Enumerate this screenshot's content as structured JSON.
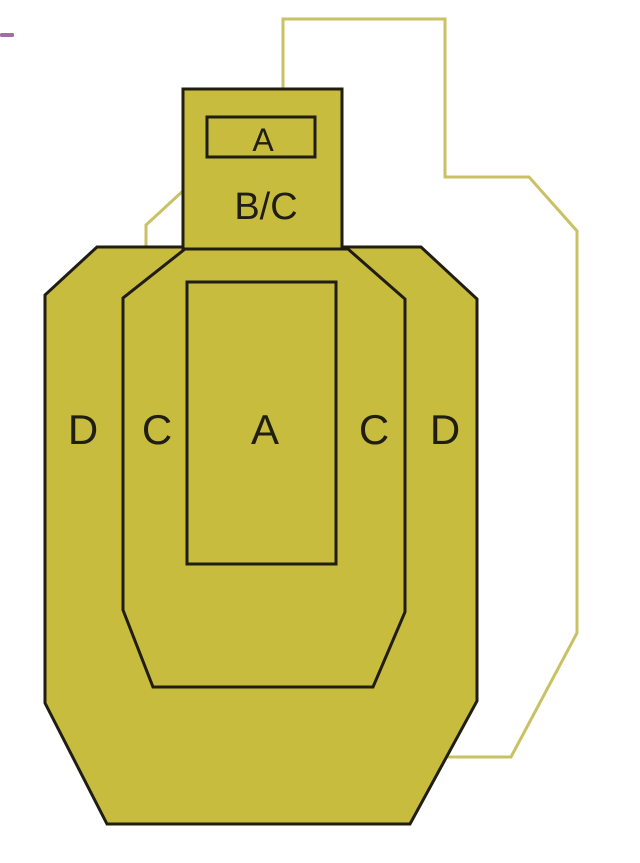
{
  "page": {
    "background_color": "#ffffff"
  },
  "scan_artifact": {
    "color": "#98509a"
  },
  "colors": {
    "target_fill": "#c8bc3e",
    "target_outline": "#201e12",
    "ghost_outline": "#c9c164"
  },
  "target": {
    "head": {
      "a_zone_label": "A",
      "bc_zone_label": "B/C"
    },
    "body": {
      "labels": [
        "D",
        "C",
        "A",
        "C",
        "D"
      ]
    }
  }
}
